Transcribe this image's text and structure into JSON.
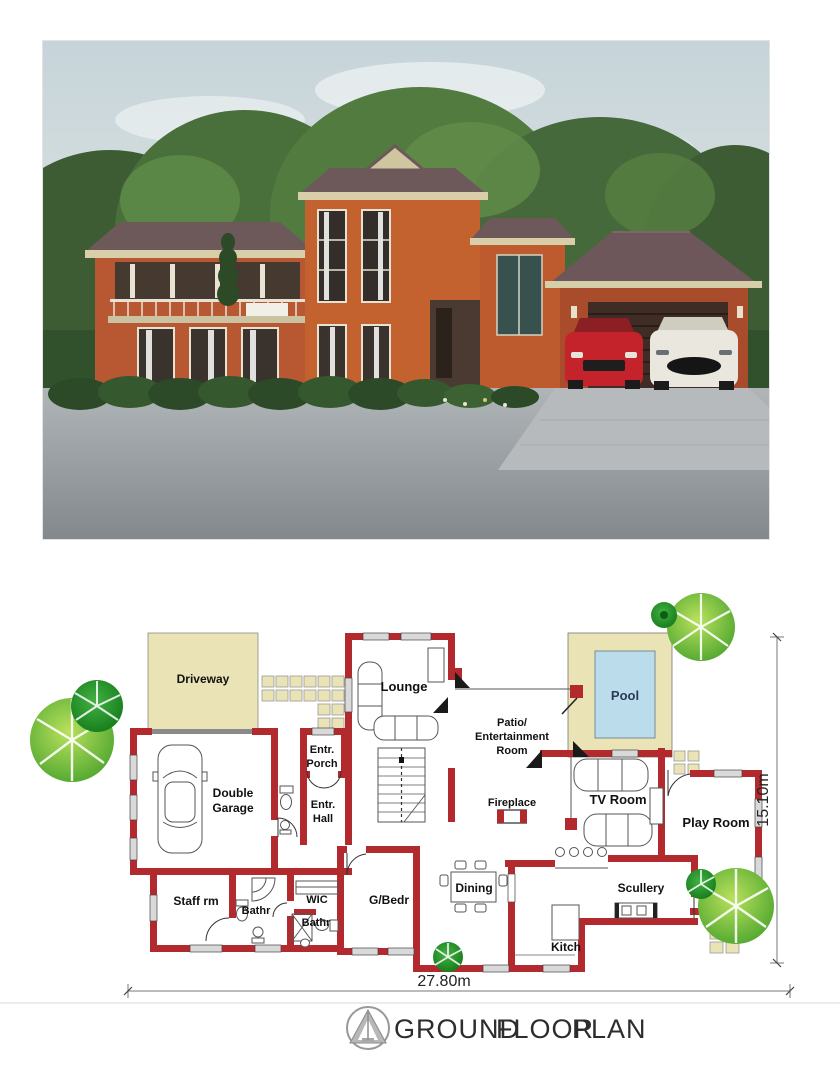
{
  "photo": {
    "description": "3D exterior render of a double-storey terracotta house with hip roofs, balcony, double garage and two cars parked on a paved driveway",
    "colors": {
      "walls": "#c0622f",
      "roof": "#6e575b",
      "trim": "#d6cda9",
      "sky": "#cfdde2",
      "trees": "#4c7340",
      "road": "#9aa0a4",
      "car_red": "#c4232b",
      "car_white": "#e9e7de"
    }
  },
  "floor_plan": {
    "labels": {
      "driveway": "Driveway",
      "lounge": "Lounge",
      "pool": "Pool",
      "patio_line1": "Patio/",
      "patio_line2": "Entertainment",
      "patio_line3": "Room",
      "fireplace": "Fireplace",
      "tv_room": "TV Room",
      "play_room": "Play Room",
      "entr_porch_line1": "Entr.",
      "entr_porch_line2": "Porch",
      "entr_hall_line1": "Entr.",
      "entr_hall_line2": "Hall",
      "double_garage_line1": "Double",
      "double_garage_line2": "Garage",
      "staff_rm": "Staff rm",
      "bathr_1": "Bathr",
      "wic": "WIC",
      "bathr_2": "Bathr",
      "g_bedr": "G/Bedr",
      "kitchen": "Kitch",
      "dining": "Dining",
      "scullery": "Scullery"
    },
    "dimensions": {
      "width": "27.80m",
      "depth": "15.10m"
    },
    "colors": {
      "wall": "#b2292e",
      "paved_area": "#eae3b6",
      "pool_water": "#badceb",
      "tree_light": "#7cc83f",
      "tree_dark": "#128a12",
      "window": "#d9d9d9"
    }
  },
  "title_block": {
    "word1": "GROUND",
    "word2": "FLOOR",
    "word3": "PLAN"
  }
}
